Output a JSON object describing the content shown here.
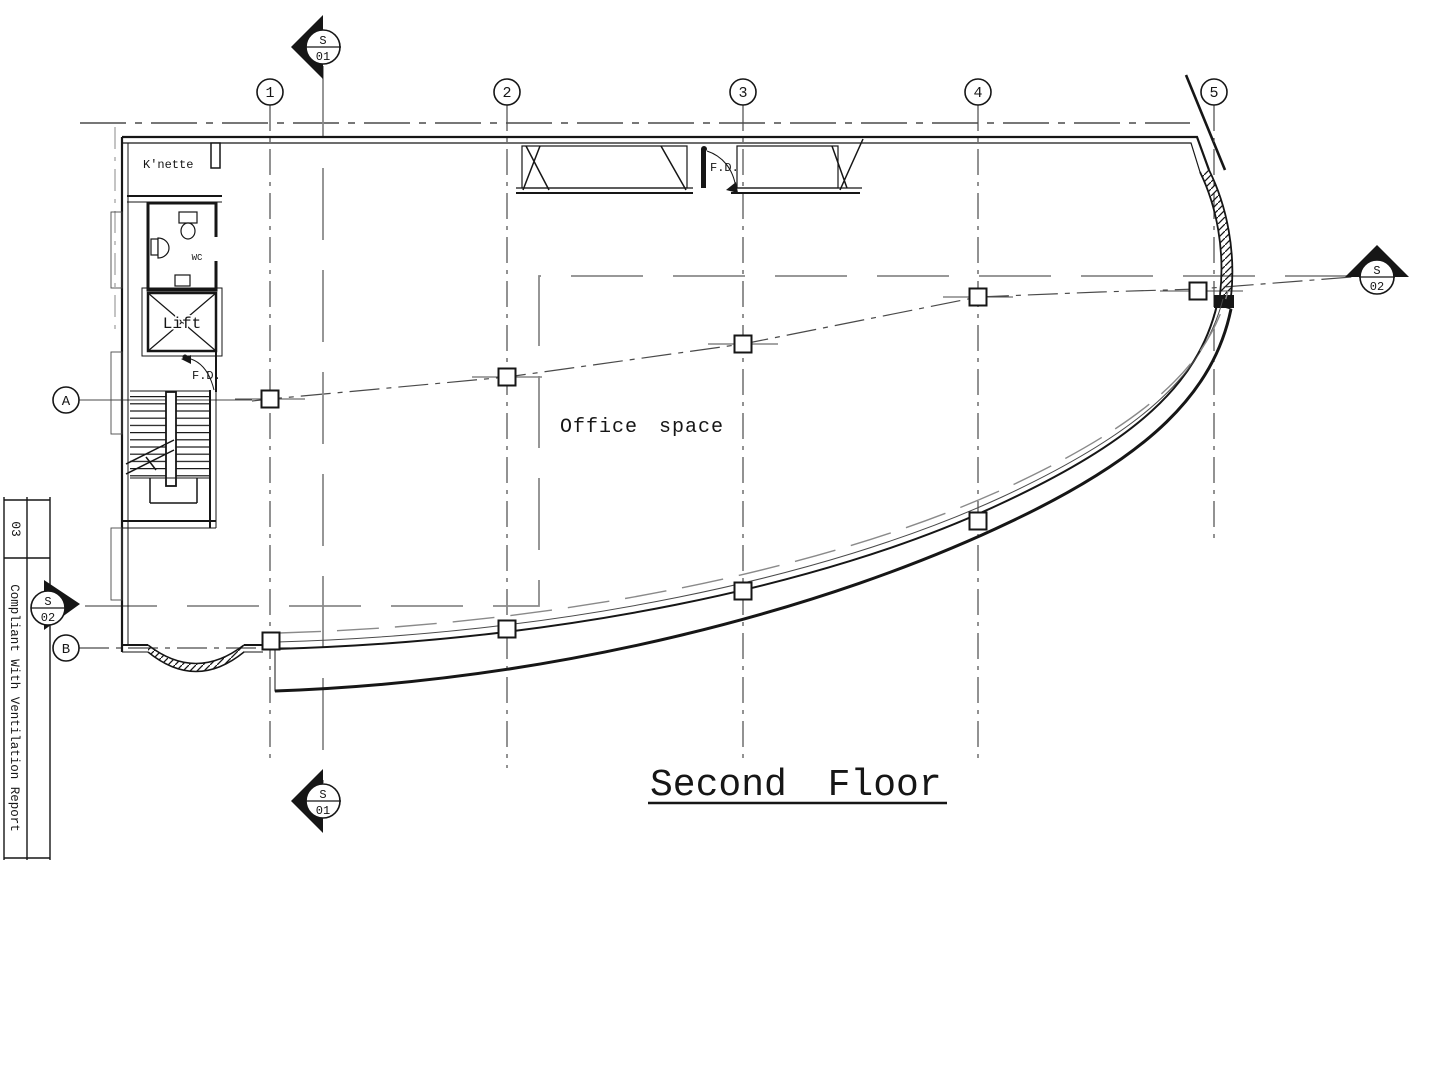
{
  "title": "Second Floor",
  "sidebar": {
    "revision_number": "03",
    "revision_note": "Compliant With Ventilation Report"
  },
  "grid": {
    "columns": [
      "1",
      "2",
      "3",
      "4",
      "5"
    ],
    "rows": [
      "A",
      "B"
    ]
  },
  "sections": {
    "s01": {
      "letter": "S",
      "number": "01"
    },
    "s02": {
      "letter": "S",
      "number": "02"
    }
  },
  "rooms": {
    "kitchenette": "K'nette",
    "wc": "WC",
    "lift": "Lift",
    "office": "Office space"
  },
  "labels": {
    "fire_door": "F.D."
  },
  "colors": {
    "ink": "#161616",
    "grid": "#4a4a4a",
    "muted": "#8a8a8a",
    "paper": "#ffffff"
  }
}
